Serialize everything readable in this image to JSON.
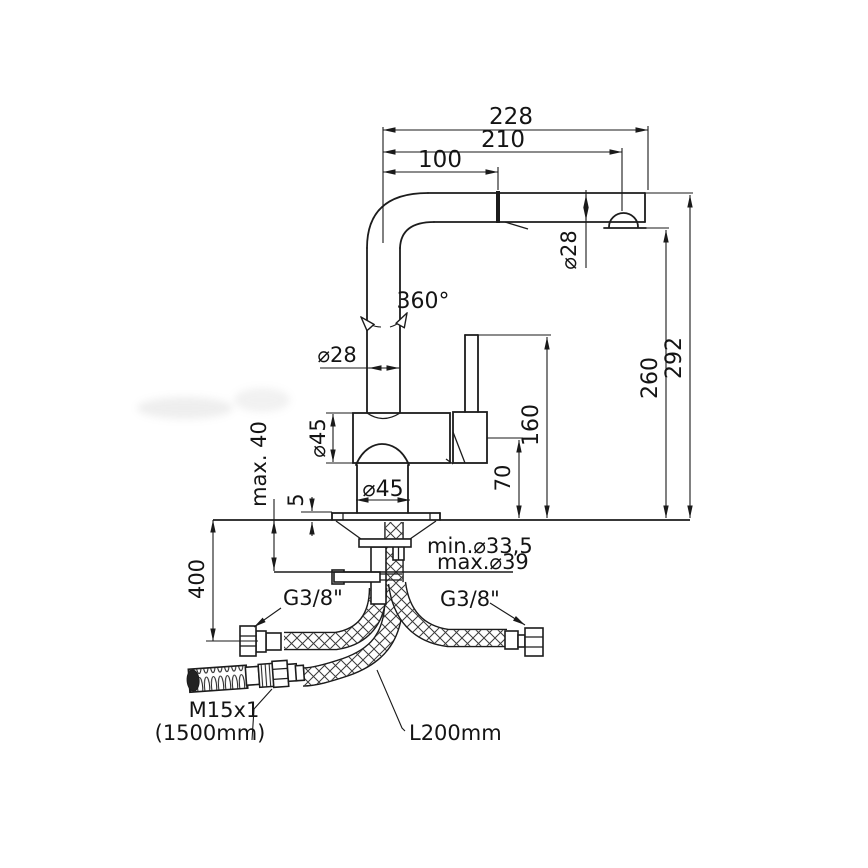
{
  "drawing": {
    "type": "technical-installation-drawing",
    "subject": "single-lever kitchen faucet with pull-out spout and supply hoses",
    "line_color": "#1c1c1c",
    "background": "#ffffff",
    "labels": {
      "top_width_total": "228",
      "top_width_to_aerator": "210",
      "top_width_inner": "100",
      "spout_tip_diameter": "⌀28",
      "riser_diameter": "⌀28",
      "swivel_angle": "360°",
      "body_diameter": "⌀45",
      "base_diameter": "⌀45",
      "height_total": "292",
      "height_to_outlet": "260",
      "height_lever_top": "160",
      "height_body": "70",
      "counter_thickness": "max. 40",
      "base_plate_height": "5",
      "hole_diameter_min": "min.⌀33,5",
      "hole_diameter_max": "max.⌀39",
      "length_below_counter": "400",
      "supply_thread_left": "G3/8\"",
      "supply_thread_right": "G3/8\"",
      "spray_hose_thread": "M15x1",
      "spray_hose_length": "(1500mm)",
      "connection_hose_length": "L200mm"
    }
  }
}
